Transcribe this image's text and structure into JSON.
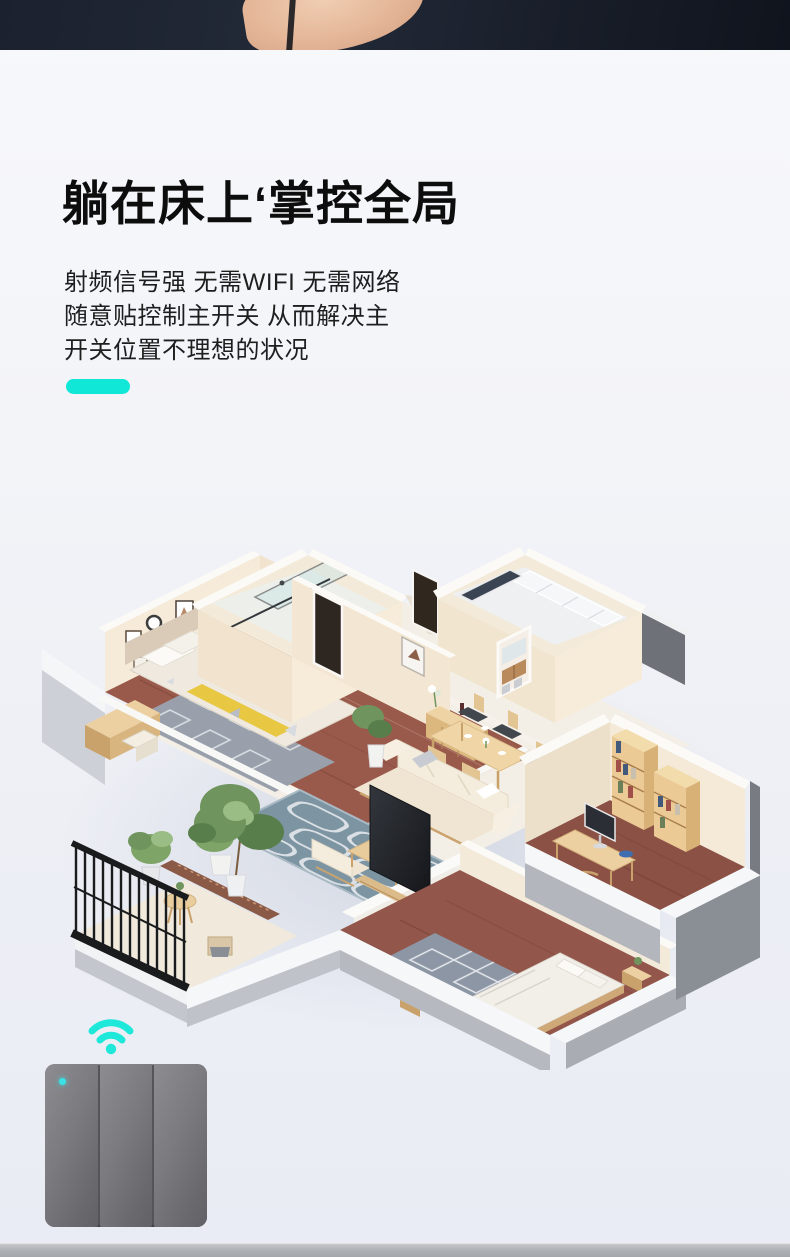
{
  "hero": {
    "strip_color": "#1d2330"
  },
  "feature": {
    "headline": "躺在床上‘掌控全局",
    "lines": [
      "射频信号强 无需WIFI 无需网络",
      "随意贴控制主开关 从而解决主",
      "开关位置不理想的状况"
    ],
    "accent_color": "#11e7d6"
  },
  "illustration": {
    "subject": "isometric-apartment-floorplan"
  },
  "icons": {
    "rf_signal": {
      "name": "wifi-signal-icon",
      "color": "#1ee8da"
    }
  },
  "product": {
    "kind": "wall-switch",
    "gangs": 3,
    "body_color": "#7b7a7f",
    "led_color": "#3ae2e6"
  }
}
